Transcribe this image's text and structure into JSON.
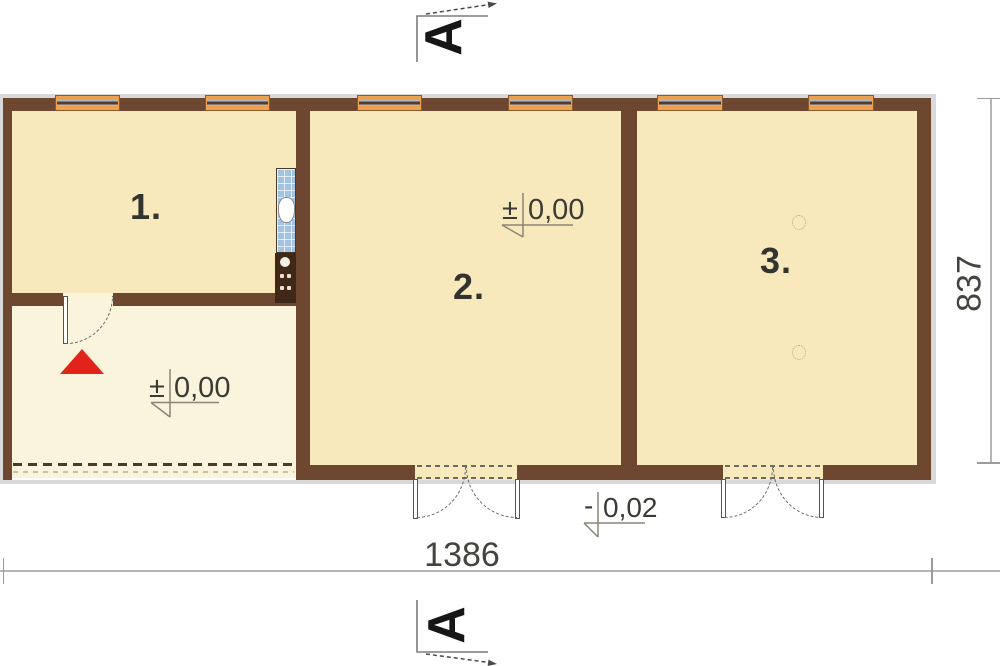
{
  "colors": {
    "wall": "#6e4731",
    "floor_main": "#f8e9bd",
    "floor_vestibule": "#faf4dc",
    "window_frame": "#eba14f",
    "window_glass": "#a9b9c9",
    "tile_blue": "#a2c4e2",
    "stove_dark": "#3f2817",
    "accent_red": "#e2231a",
    "dim_line": "#b5b5b5",
    "shadow": "#d9d9d9",
    "text": "#33332f"
  },
  "section_markers": {
    "top_letter": "A",
    "bottom_letter": "A"
  },
  "rooms": [
    {
      "label": "1."
    },
    {
      "label": "2."
    },
    {
      "label": "3."
    }
  ],
  "level_markers": {
    "vestibule": {
      "sign": "±",
      "value": "0,00"
    },
    "room2": {
      "sign": "±",
      "value": "0,00"
    },
    "exterior": {
      "sign": "-",
      "value": "0,02"
    }
  },
  "dimensions": {
    "width_label": "1386",
    "height_label": "837"
  }
}
